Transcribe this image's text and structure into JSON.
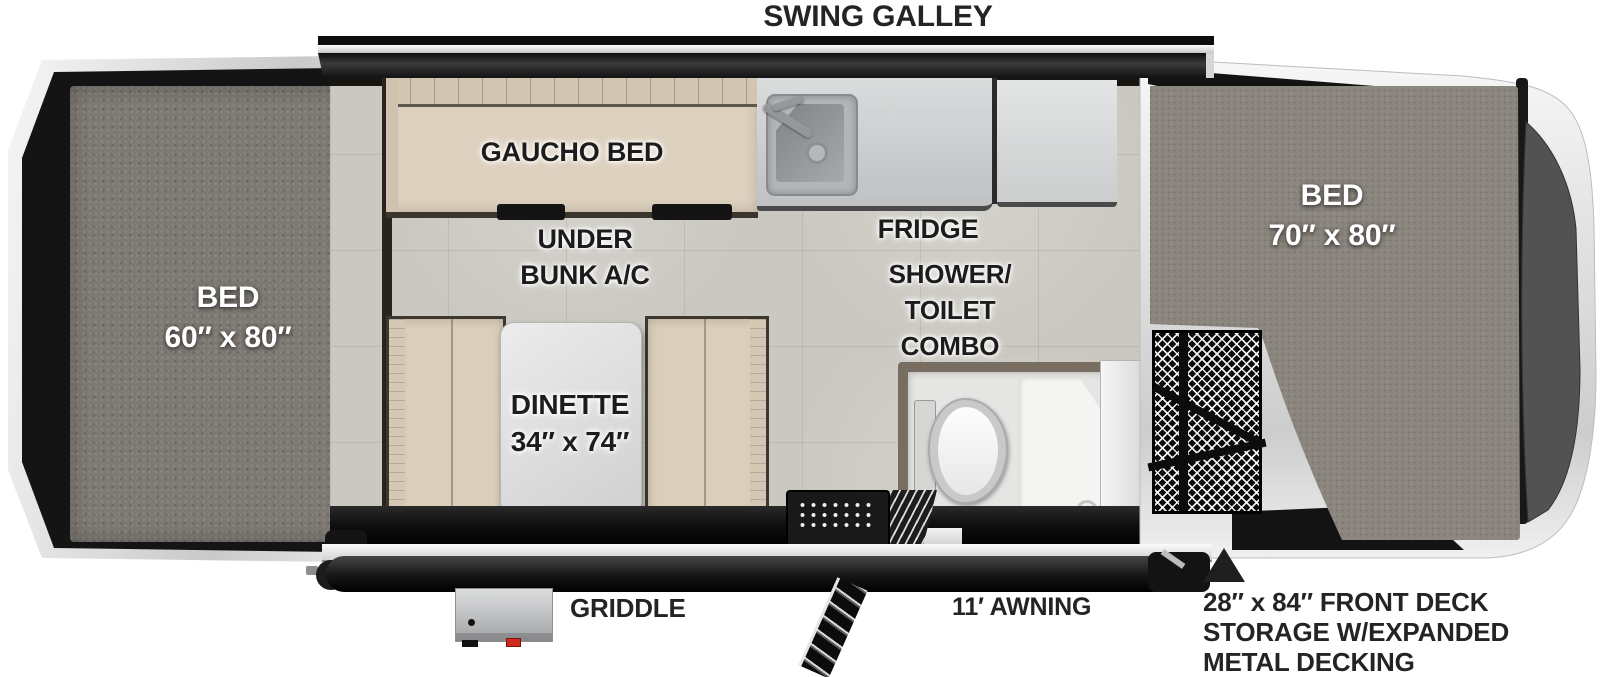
{
  "title": "SWING GALLEY",
  "labels": {
    "swing_galley": "SWING GALLEY",
    "gaucho_bed": "GAUCHO BED",
    "under_bunk_ac": [
      "UNDER",
      "BUNK A/C"
    ],
    "fridge": "FRIDGE",
    "shower_toilet_combo": [
      "SHOWER/",
      "TOILET",
      "COMBO"
    ],
    "dinette": [
      "DINETTE",
      "34″ x 74″"
    ],
    "bed_left": [
      "BED",
      "60″ x 80″"
    ],
    "bed_right": [
      "BED",
      "70″ x 80″"
    ],
    "griddle": "GRIDDLE",
    "awning": "11′ AWNING",
    "front_deck": [
      "28″ x 84″ FRONT DECK",
      "STORAGE W/EXPANDED",
      "METAL DECKING"
    ]
  },
  "colors": {
    "carpet_grey": "#86817a",
    "cushion_beige": "#dccfbd",
    "floor_tile": "#cbc8c1",
    "frame_silver": "#e9e9e9",
    "body_dark": "#141414",
    "counter_grey": "#cfd1d2",
    "shower_frame_brown": "#776d60",
    "latch_red": "#cf2a1e",
    "label_dark": "#1c1c1c",
    "label_white": "#ffffff"
  }
}
